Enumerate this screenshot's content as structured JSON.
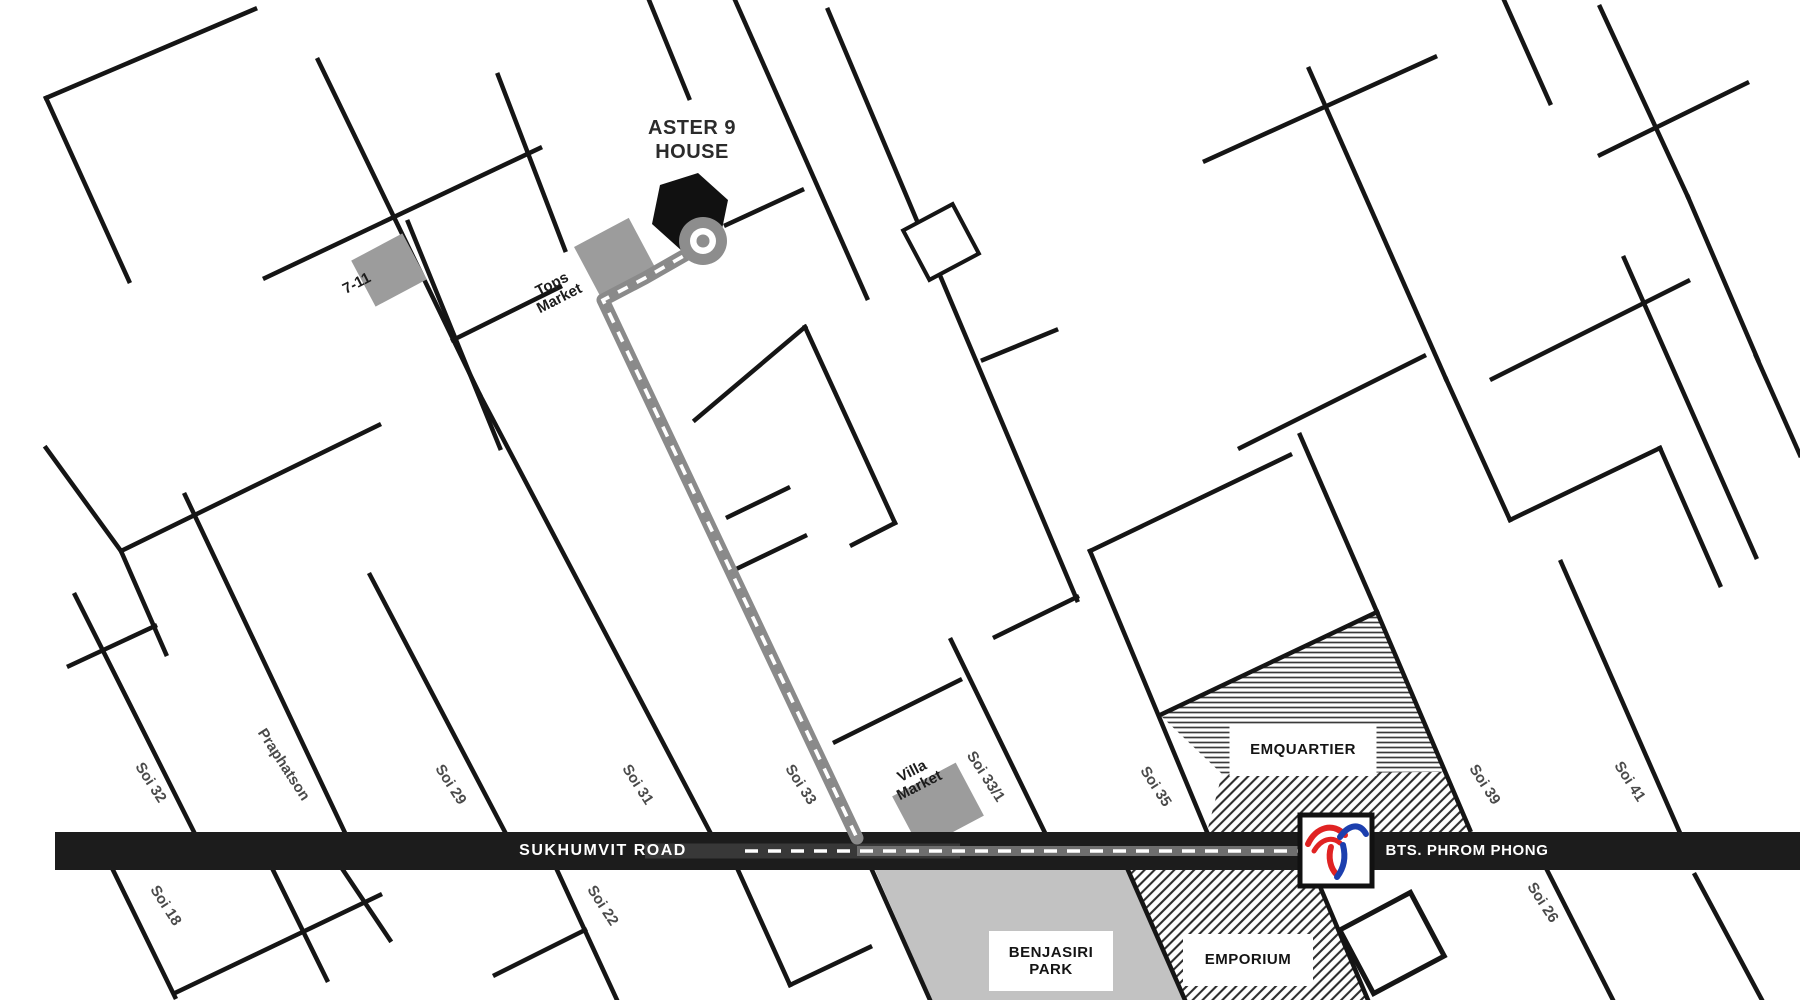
{
  "landmark": {
    "line1": "ASTER 9",
    "line2": "HOUSE"
  },
  "road": {
    "name": "SUKHUMVIT ROAD"
  },
  "station": {
    "name": "BTS. PHROM PHONG",
    "icon": "bts-logo-icon"
  },
  "markets": {
    "seven_eleven": "7-11",
    "tops_line1": "Tops",
    "tops_line2": "Market",
    "villa_line1": "Villa",
    "villa_line2": "Market"
  },
  "areas": {
    "emquartier": "EMQUARTIER",
    "emporium": "EMPORIUM",
    "benjasiri_line1": "BENJASIRI",
    "benjasiri_line2": "PARK"
  },
  "sois": {
    "soi32": "Soi 32",
    "praphatson": "Praphatson",
    "soi29": "Soi 29",
    "soi31": "Soi 31",
    "soi33": "Soi 33",
    "soi33_1": "Soi 33/1",
    "soi35": "Soi 35",
    "soi39": "Soi 39",
    "soi41": "Soi 41",
    "soi18": "Soi 18",
    "soi22": "Soi 22",
    "soi26": "Soi 26"
  },
  "icons": {
    "destination": "house-hexagon-icon",
    "route_start": "roundabout-icon",
    "station": "bts-logo-icon"
  },
  "colors": {
    "street": "#151515",
    "road_band": "#1c1c1c",
    "building": "#9c9c9c",
    "park": "#c2c2c2",
    "route": "#8a8a8a",
    "hatch": "#3a3a3a",
    "bts_red": "#e02323",
    "bts_blue": "#1c3fae"
  }
}
